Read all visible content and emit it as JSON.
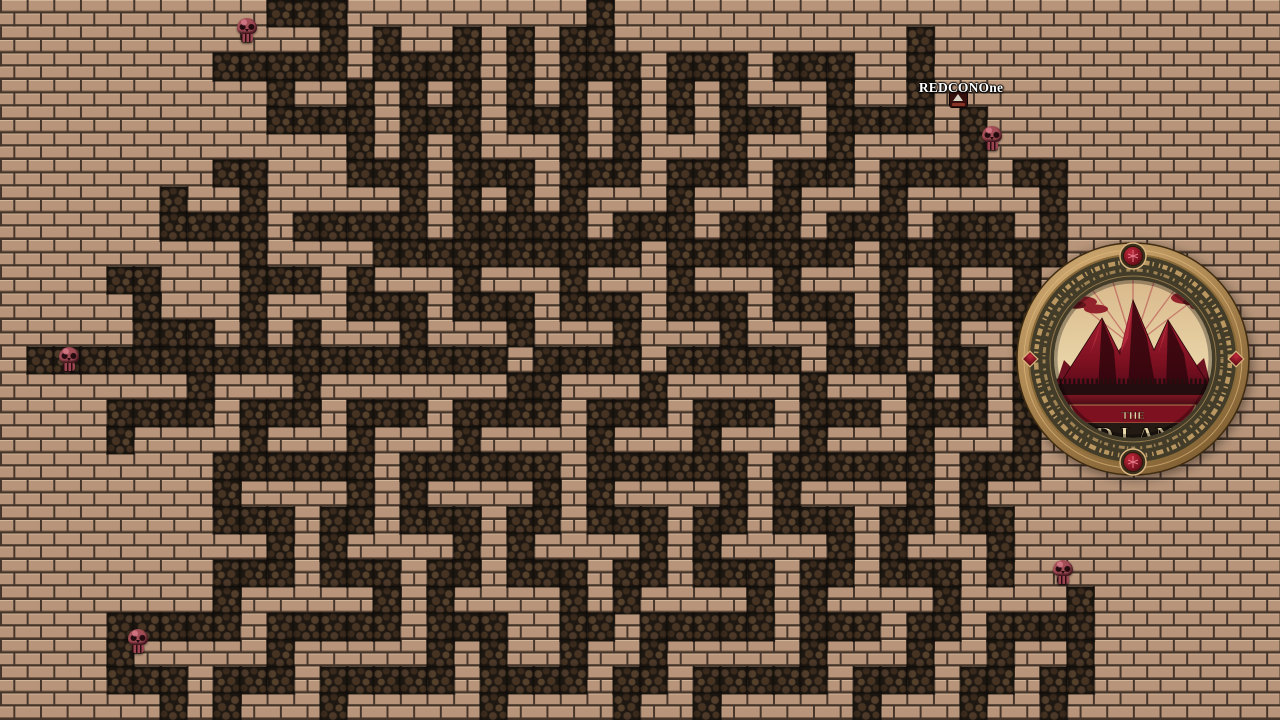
{
  "player": {
    "name": "REDCONOne",
    "x": 949,
    "y": 91,
    "name_label_x": 961,
    "name_label_y": 80
  },
  "logo": {
    "line1": "THE",
    "line2": "RED LANDS",
    "x": 1016,
    "y": 242,
    "size": 234
  },
  "sprites": {
    "skulls": [
      {
        "x": 236,
        "y": 18
      },
      {
        "x": 58,
        "y": 347
      },
      {
        "x": 981,
        "y": 126
      },
      {
        "x": 1052,
        "y": 560
      },
      {
        "x": 127,
        "y": 629
      }
    ]
  },
  "maze": {
    "cols": 48,
    "rows": 27,
    "legend": {
      "#": "wall",
      ".": "floor"
    },
    "grid": [
      "..........###.........#.........................",
      "............#.#..#.#.##...........#.............",
      "........#####.####.#.###.###.###..#.............",
      "..........#..#.#.#.#.#.#.#.#...#..#.............",
      "..........####.###.###.#.#.###.####.#...........",
      ".............#.#.#...#.#...#...#....#...........",
      "........##...###.###.###.###.###.####.##........",
      "......#..#.....#.#.#.#...#...#...#.....#........",
      "......####.#####.#####.###.###.###.###.#........",
      ".........#....##########.#######.#######........",
      "....##...###.#...#...#...#...#...#.#..#.........",
      ".....#...#...###.###.###.###.###.#.####.........",
      ".....###.#.#...#...#...#...#...#.#.#..#.........",
      ".##################.####.#####.###.##.#.........",
      ".......#...#.......##...#.....#...#.#.#.........",
      "....####.###.###.####.###.###.###.###.#.........",
      "....#....#...#...#....#...#...#...#...#.........",
      "........######.######.######.######.###.........",
      "........#....#.#....#.#....#.#....#.#...........",
      "........###.##.###.##.###.##.###.##.##..........",
      "..........#.#....#.#....#.#....#.#...#..........",
      "........###.###.##.###.##.###.##.###.#..........",
      "........#.....#.#....#.#....#.#....#....#.......",
      "....#####.#####.###..##.#####.###.##.####.......",
      "....#.....#.....#.#..#..#.....#...#..#..#.......",
      "....###.###.#####.####.##.#####.###.##.##.......",
      "......#.#...#.....#....#..#.....#...#..#........"
    ]
  },
  "colors": {
    "brick": "#b8957a",
    "brick_highlight": "#d0ae8d",
    "mortar": "#45352a",
    "wall": "#1f1812",
    "wall_stone": "#4c3929",
    "skull": "#a34d56",
    "player_name": "#ffffff",
    "logo_bronze": "#c9a063",
    "logo_band": "#423c29",
    "logo_red": "#8c1020",
    "logo_text": "#ead9ab"
  }
}
